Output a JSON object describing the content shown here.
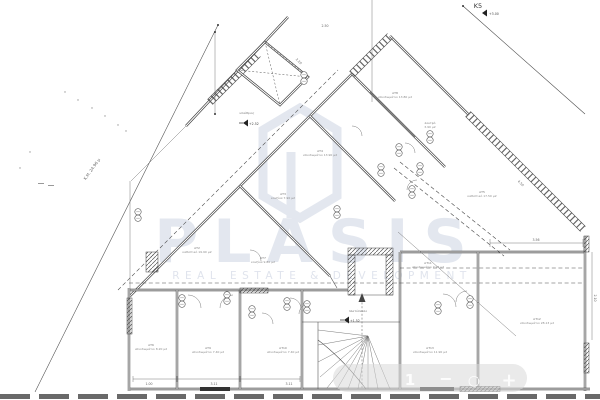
{
  "plan": {
    "boundary_label": {
      "text": "Κ.Μ. 24.96 μ"
    },
    "k5": {
      "label": "K5",
      "level": "+3.00"
    },
    "levels": [
      {
        "x": 249,
        "y": 125,
        "text": "+2.52"
      },
      {
        "x": 350,
        "y": 322,
        "text": "+1.52"
      }
    ],
    "annotations": [
      {
        "x": 247,
        "y": 114,
        "text": "υπαίθριος"
      },
      {
        "x": 358,
        "y": 312,
        "text": "πλατύσκαλο"
      }
    ],
    "rooms": [
      {
        "x": 320,
        "y": 152,
        "code": "ΑΤ4",
        "desc": "υπνοδωμάτιο 13.90 μ2"
      },
      {
        "x": 395,
        "y": 94,
        "code": "ΑΤ8",
        "desc": "υπνοδωμάτιο 13.80 μ2"
      },
      {
        "x": 430,
        "y": 124,
        "code": "λουτρό",
        "desc": "3.90 μ2"
      },
      {
        "x": 482,
        "y": 193,
        "code": "ΑΤ5",
        "desc": "καθιστικό 17.50 μ2"
      },
      {
        "x": 283,
        "y": 195,
        "code": "ΑΤ3",
        "desc": "κουζίνα 7.90 μ2"
      },
      {
        "x": 197,
        "y": 249,
        "code": "ΑΤ2",
        "desc": "καθιστικό 19.90 μ2"
      },
      {
        "x": 263,
        "y": 259,
        "code": "ΑΤ7",
        "desc": "κουζίνα 9.80 μ2"
      },
      {
        "x": 151,
        "y": 346,
        "code": "ΑΤ6",
        "desc": "υπνοδωμάτιο 8.20 μ2"
      },
      {
        "x": 208,
        "y": 349,
        "code": "ΑΤ9",
        "desc": "υπνοδωμάτιο 7.40 μ2"
      },
      {
        "x": 283,
        "y": 349,
        "code": "ΑΤ10",
        "desc": "υπνοδωμάτιο 7.40 μ2"
      },
      {
        "x": 430,
        "y": 349,
        "code": "ΑΤ13",
        "desc": "υπνοδωμάτιο 11.90 μ2"
      },
      {
        "x": 537,
        "y": 320,
        "code": "ΑΤ12",
        "desc": "υπνοδωμάτιο 28.13 μ2"
      },
      {
        "x": 428,
        "y": 264,
        "code": "ΑΤ11",
        "desc": "υπνοδωμάτιο 7.95 μ2"
      }
    ],
    "dimensions": [
      {
        "x": 325,
        "y": 27,
        "text": "2.50",
        "rot": 0
      },
      {
        "x": 298,
        "y": 62,
        "text": "2.20",
        "rot": 45
      },
      {
        "x": 520,
        "y": 184,
        "text": "4.50",
        "rot": 45
      },
      {
        "x": 536,
        "y": 241,
        "text": "3.56",
        "rot": 0
      },
      {
        "x": 149,
        "y": 385,
        "text": "1.00",
        "rot": 0
      },
      {
        "x": 214,
        "y": 385,
        "text": "3.11",
        "rot": 0
      },
      {
        "x": 289,
        "y": 385,
        "text": "3.11",
        "rot": 0
      },
      {
        "x": 594,
        "y": 298,
        "text": "2.10",
        "rot": 90
      }
    ],
    "door_tags": [
      [
        304,
        78
      ],
      [
        430,
        137
      ],
      [
        399,
        150
      ],
      [
        420,
        169
      ],
      [
        412,
        192
      ],
      [
        381,
        170
      ],
      [
        337,
        212
      ],
      [
        138,
        215
      ],
      [
        182,
        301
      ],
      [
        227,
        298
      ],
      [
        252,
        312
      ],
      [
        287,
        304
      ],
      [
        307,
        307
      ],
      [
        470,
        302
      ],
      [
        438,
        308
      ]
    ]
  },
  "watermark": {
    "logo": "plasis-hexagon",
    "word": "PLASIS",
    "tagline": "REAL ESTATE & DEVELOPMENT"
  },
  "viewer": {
    "page": "1",
    "zoom_out": "−",
    "zoom_reset": "○",
    "zoom_in": "+"
  },
  "colors": {
    "line": "#3a3a3a",
    "watermark": "#e3e7ef",
    "ground": "#4f4f4f",
    "pill": "#d9d9d9"
  }
}
